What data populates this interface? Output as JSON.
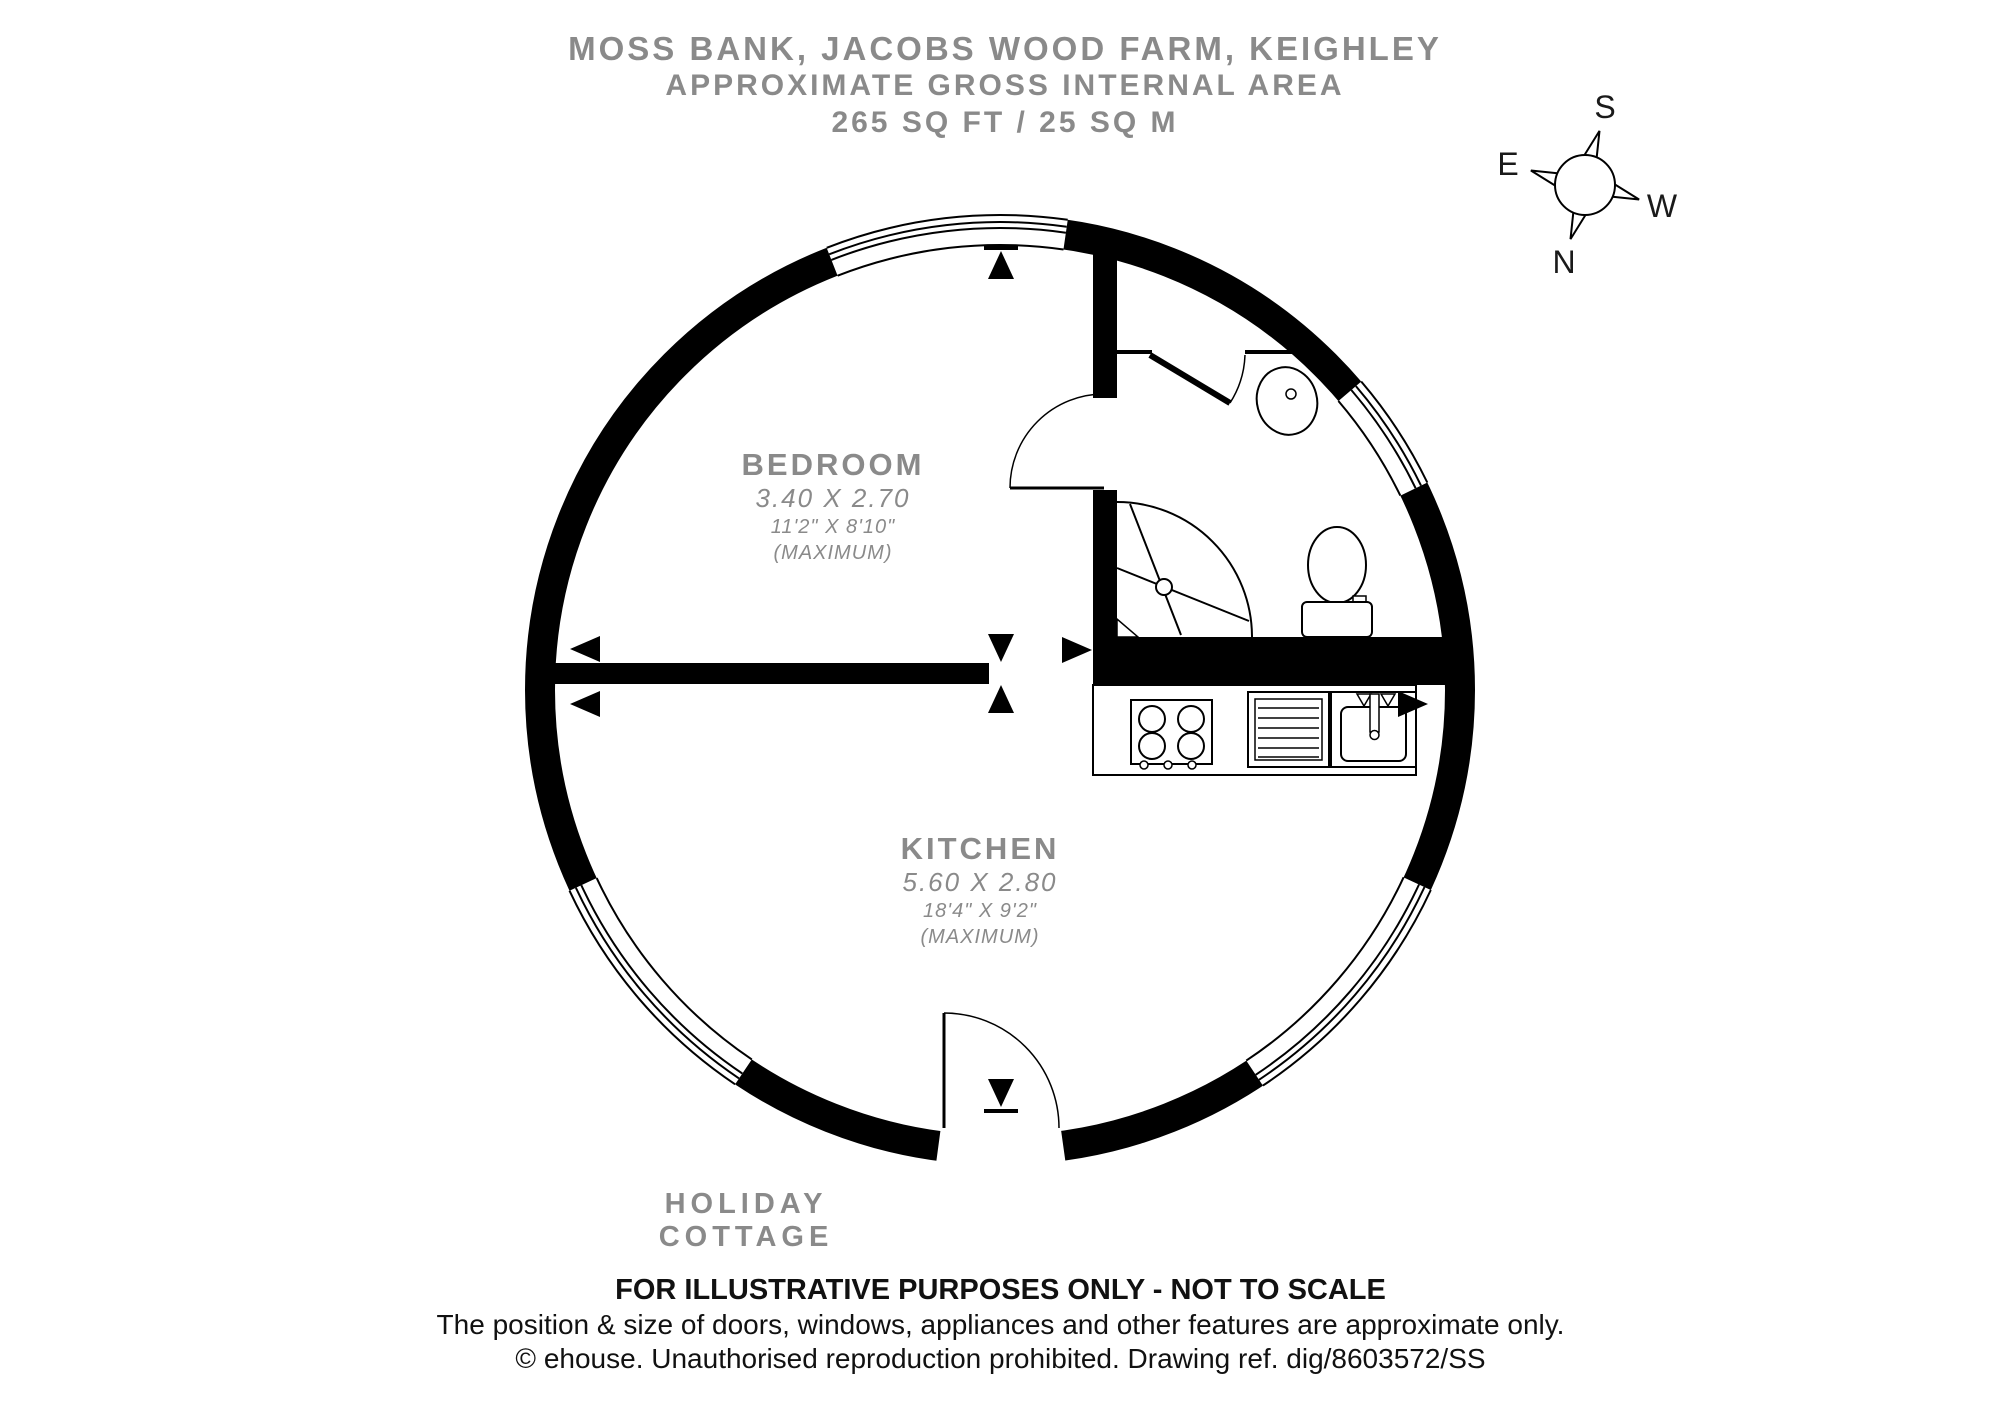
{
  "header": {
    "line1": "MOSS BANK, JACOBS WOOD FARM, KEIGHLEY",
    "line2": "APPROXIMATE GROSS INTERNAL AREA",
    "line3": "265 SQ FT / 25 SQ M"
  },
  "compass": {
    "north": "N",
    "south": "S",
    "east": "E",
    "west": "W"
  },
  "rooms": {
    "bedroom": {
      "name": "BEDROOM",
      "metric": "3.40 X 2.70",
      "imperial": "11'2\" X 8'10\"",
      "note": "(MAXIMUM)"
    },
    "kitchen": {
      "name": "KITCHEN",
      "metric": "5.60 X 2.80",
      "imperial": "18'4\" X 9'2\"",
      "note": "(MAXIMUM)"
    }
  },
  "plan": {
    "label": "HOLIDAY COTTAGE"
  },
  "footer": {
    "line1": "FOR ILLUSTRATIVE PURPOSES ONLY - NOT TO SCALE",
    "line2": "The position & size of doors, windows, appliances and other features are approximate only.",
    "line3": "© ehouse. Unauthorised reproduction prohibited. Drawing ref. dig/8603572/SS"
  },
  "colors": {
    "label_gray": "#8a8a8a",
    "ink": "#000000",
    "paper": "#ffffff"
  }
}
